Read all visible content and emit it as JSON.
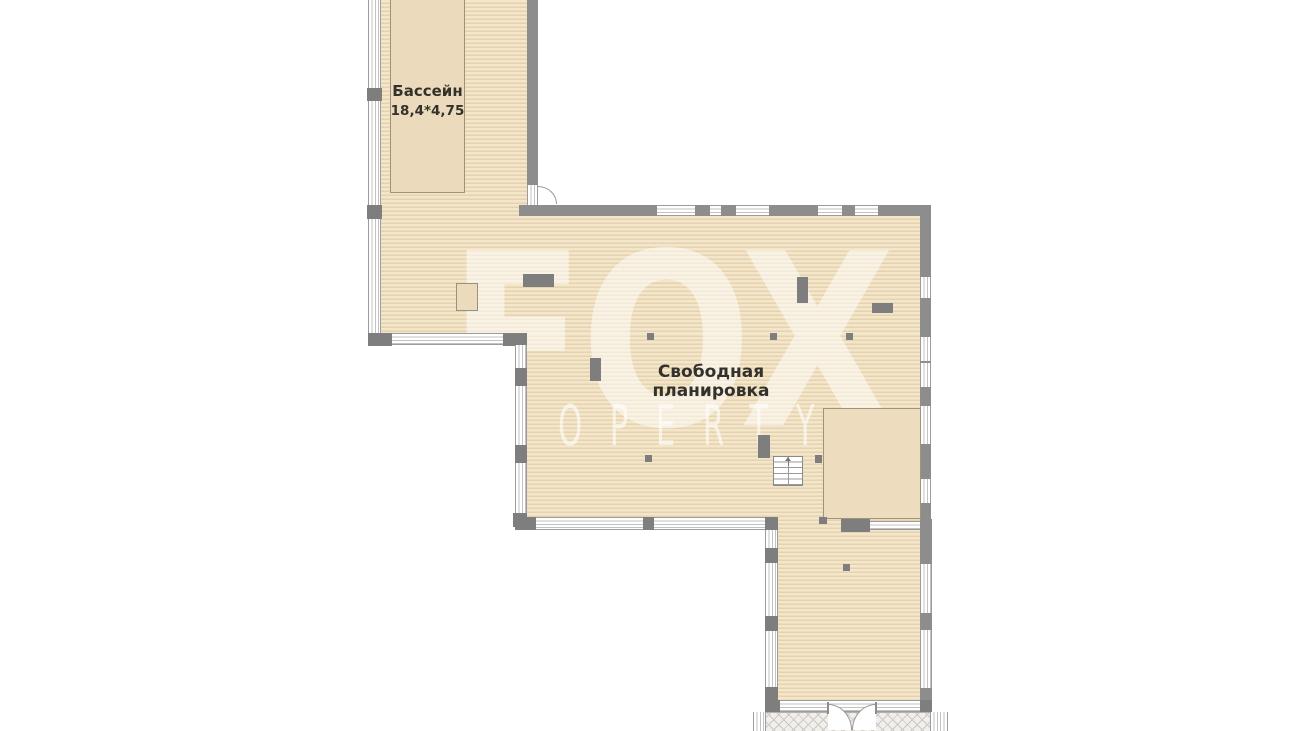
{
  "labels": {
    "pool_name": "Бассейн",
    "pool_dimensions": "18,4*4,75",
    "open_plan_line1": "Свободная",
    "open_plan_line2": "планировка"
  },
  "watermark": {
    "brand": "FOX",
    "brand_sub": "OPERTY"
  },
  "colors": {
    "wall": "#8d8d8d",
    "wall_dark": "#7e7e7e",
    "floor_light": "#f2e6cc",
    "floor_dark": "#e7d2ac",
    "pool_fill": "#ebdbbc",
    "room_fill": "#eddcbe",
    "outline": "#a0937a",
    "label_text": "#33312c",
    "win_line": "#c2c2c2",
    "win_border": "#9c9c9c",
    "terrace_bg": "#f1efeb",
    "terrace_line": "#ccc7c0"
  }
}
